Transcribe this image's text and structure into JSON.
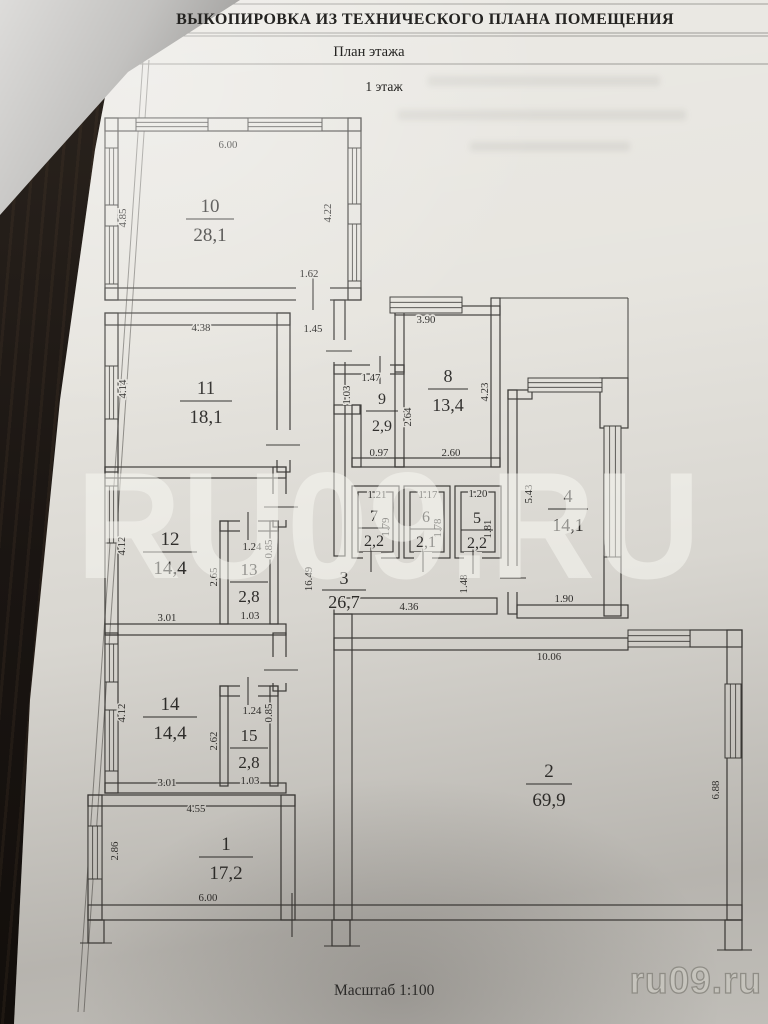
{
  "document": {
    "title": "ВЫКОПИРОВКА ИЗ ТЕХНИЧЕСКОГО ПЛАНА ПОМЕЩЕНИЯ",
    "subtitle": "План этажа",
    "floor_label": "1 этаж",
    "scale_label": "Масштаб 1:100"
  },
  "watermarks": {
    "center": "RU09.RU",
    "corner": "ru09.ru"
  },
  "rooms": {
    "r1": {
      "number": "1",
      "area": "17,2"
    },
    "r2": {
      "number": "2",
      "area": "69,9"
    },
    "r3": {
      "number": "3",
      "area": "26,7"
    },
    "r4": {
      "number": "4",
      "area": "14,1"
    },
    "r5": {
      "number": "5",
      "area": "2,2"
    },
    "r6": {
      "number": "6",
      "area": "2,1"
    },
    "r7": {
      "number": "7",
      "area": "2,2"
    },
    "r8": {
      "number": "8",
      "area": "13,4"
    },
    "r9": {
      "number": "9",
      "area": "2,9"
    },
    "r10": {
      "number": "10",
      "area": "28,1"
    },
    "r11": {
      "number": "11",
      "area": "18,1"
    },
    "r12": {
      "number": "12",
      "area": "14,4"
    },
    "r13": {
      "number": "13",
      "area": "2,8"
    },
    "r14": {
      "number": "14",
      "area": "14,4"
    },
    "r15": {
      "number": "15",
      "area": "2,8"
    }
  },
  "dims": {
    "d10_top": "6.00",
    "d10_left": "4.85",
    "d10_right": "4.22",
    "d10_door": "1.62",
    "d11_top": "4.38",
    "d11_left": "4.14",
    "d_corr_top": "1.45",
    "d12_left": "4.12",
    "d12_right": "2.65",
    "d12_bottom": "3.01",
    "d13_top": "1.24",
    "d13_side": "0.85",
    "d13_bottom": "1.03",
    "d14_left": "4.12",
    "d14_right": "2.62",
    "d14_bottom": "3.01",
    "d15_top": "1.24",
    "d15_side": "0.85",
    "d15_bottom": "1.03",
    "d1_top": "4.55",
    "d1_left": "2.86",
    "d1_bottom": "6.00",
    "d9_top": "1.47",
    "d9_left": "1.03",
    "d9_bottom": "0.97",
    "d8_top": "3.90",
    "d8_right": "4.23",
    "d8_left": "2.64",
    "d8_bottom": "2.60",
    "d7_top": "1.21",
    "d7_right": "1.79",
    "d6_top": "1.17",
    "d6_right": "1.78",
    "d5_top": "1.20",
    "d5_right": "1.81",
    "d4_left": "5.43",
    "d4_bottom": "1.90",
    "d3_height": "16.49",
    "d3_bottom": "4.36",
    "d3_door": "1.48",
    "d2_top": "10.06",
    "d2_right": "6.88"
  }
}
